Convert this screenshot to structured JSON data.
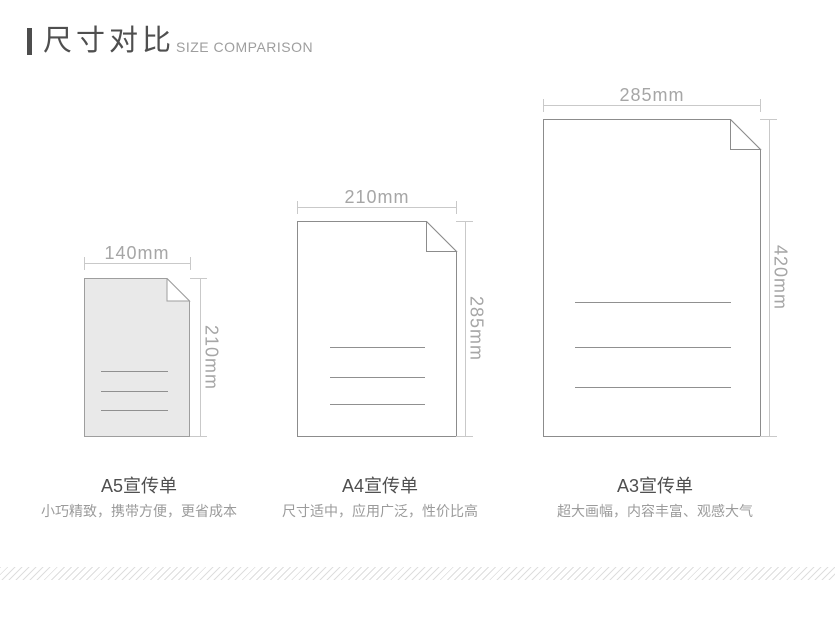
{
  "header": {
    "title_cn": "尺寸对比",
    "title_en": "SIZE COMPARISON"
  },
  "papers": [
    {
      "name": "A5",
      "width_label": "140mm",
      "height_label": "210mm",
      "title": "A5宣传单",
      "description": "小巧精致，携带方便，更省成本"
    },
    {
      "name": "A4",
      "width_label": "210mm",
      "height_label": "285mm",
      "title": "A4宣传单",
      "description": "尺寸适中，应用广泛，性价比高"
    },
    {
      "name": "A3",
      "width_label": "285mm",
      "height_label": "420mm",
      "title": "A3宣传单",
      "description": "超大画幅，内容丰富、观感大气"
    }
  ],
  "colors": {
    "accent_dark": "#4d4d4d",
    "heading_text": "#4f4f4f",
    "subtitle_text": "#9e9e9e",
    "dimension_line": "#c9c9c9",
    "dimension_text": "#a6a6a6",
    "paper_border": "#8c8c8c",
    "a5_paper_fill": "#e9e9e9",
    "content_line": "#909090",
    "description_text": "#9b9b9b",
    "stripe": "#dedede"
  }
}
